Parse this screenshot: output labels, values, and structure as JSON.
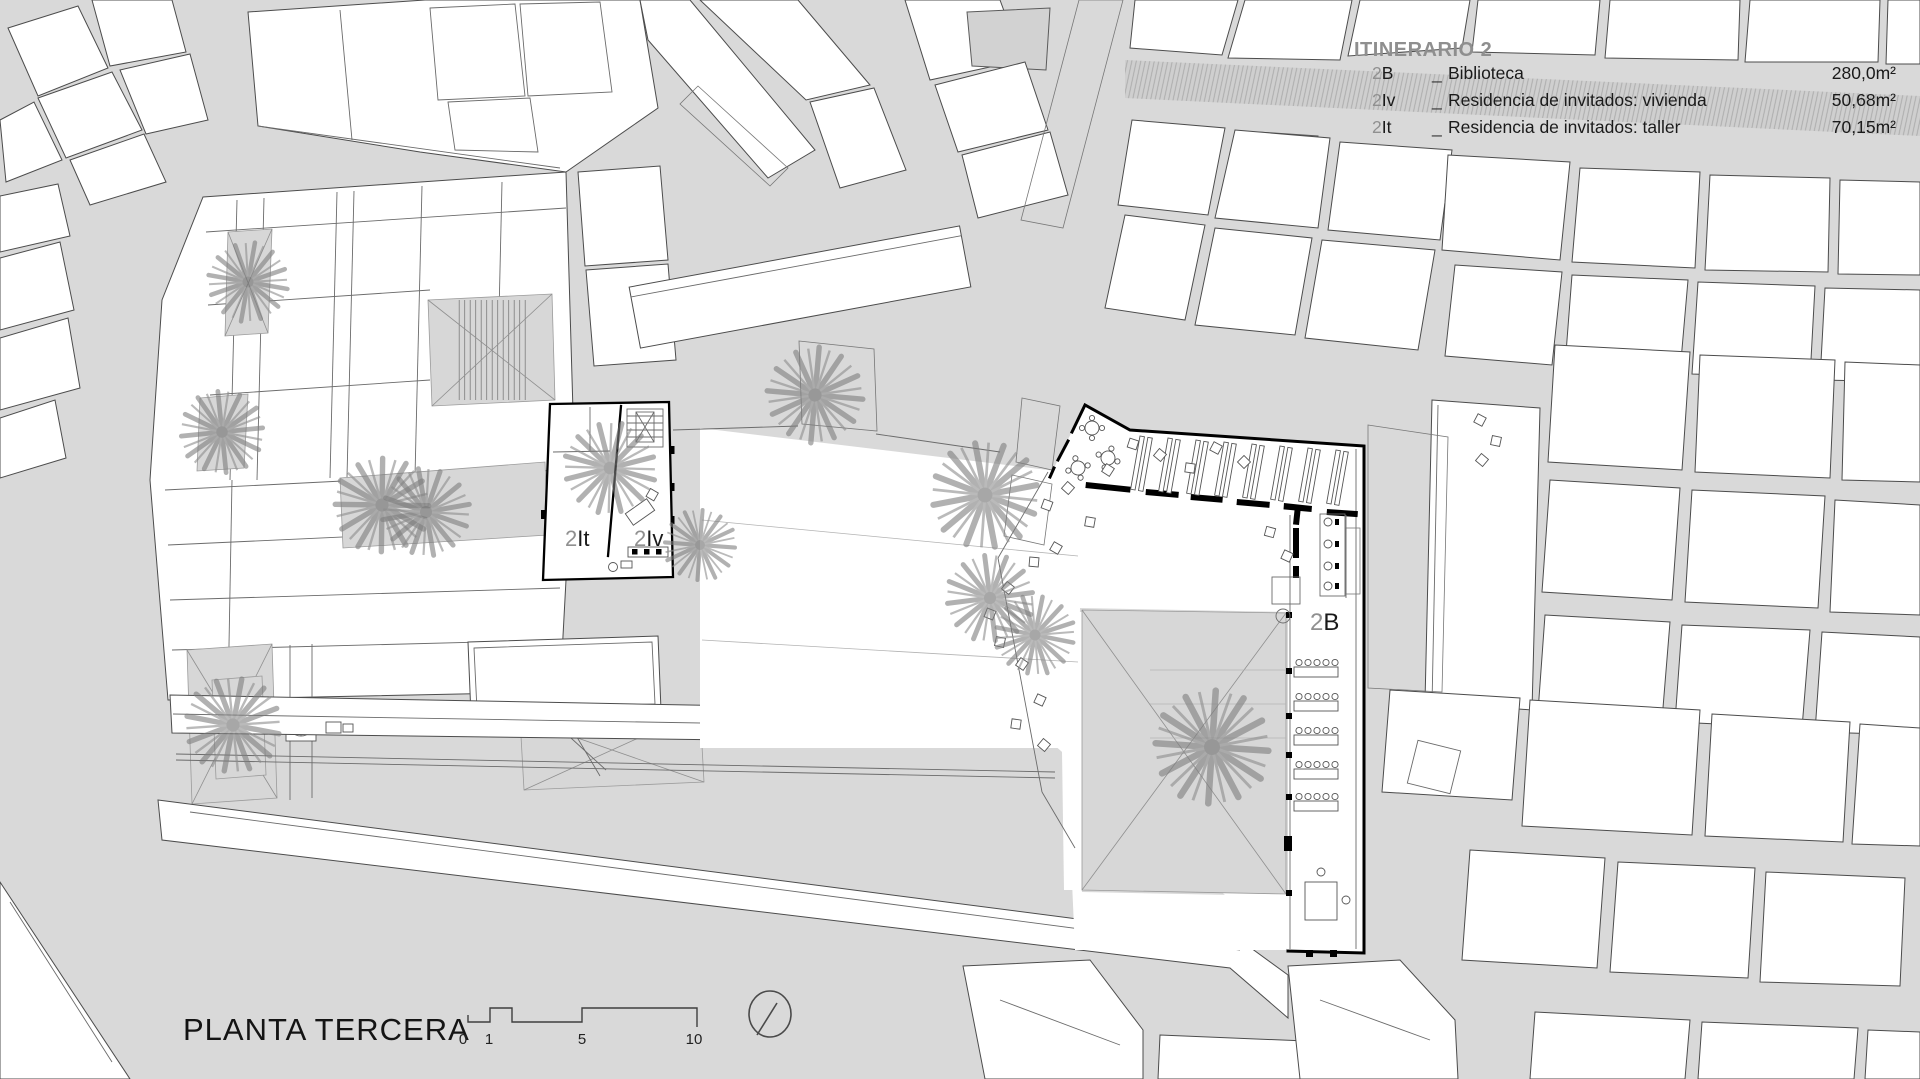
{
  "legend": {
    "title": "ITINERARIO 2",
    "items": [
      {
        "num": "2",
        "letters": "B",
        "sep": "_",
        "name": "Biblioteca",
        "area": "280,0m²"
      },
      {
        "num": "2",
        "letters": "Iv",
        "sep": "_",
        "name": "Residencia de invitados: vivienda",
        "area": "50,68m²"
      },
      {
        "num": "2",
        "letters": "It",
        "sep": "_",
        "name": "Residencia de invitados: taller",
        "area": "70,15m²"
      }
    ]
  },
  "plan_labels": {
    "taller": {
      "num": "2",
      "letters": "It"
    },
    "vivienda": {
      "num": "2",
      "letters": "Iv"
    },
    "biblioteca": {
      "num": "2",
      "letters": "B"
    }
  },
  "title_block": {
    "title": "PLANTA TERCERA",
    "scale_ticks": [
      "0",
      "1",
      "5",
      "10"
    ]
  },
  "colors": {
    "background": "#d9d9d9",
    "paper": "#ffffff",
    "context_line": "#4c4c4c",
    "bold_wall": "#000000",
    "palm": "#868686",
    "courtyard": "#d7d7d7",
    "legend_title": "#8f8f8f",
    "text": "#1a1a1a"
  }
}
